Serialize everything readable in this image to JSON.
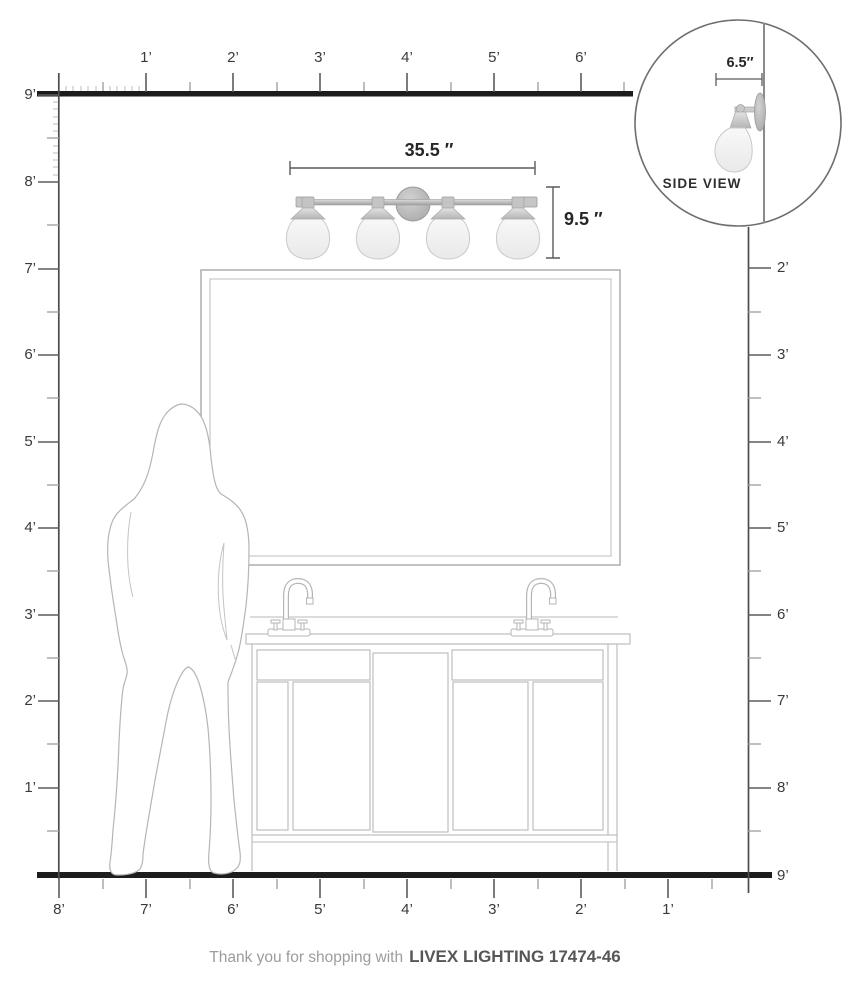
{
  "title": "Livex Lighting 17474-46 scale diagram",
  "rulers": {
    "top": {
      "labels": [
        "1’",
        "2’",
        "3’",
        "4’",
        "5’",
        "6’"
      ]
    },
    "left": {
      "labels": [
        "9’",
        "8’",
        "7’",
        "6’",
        "5’",
        "4’",
        "3’",
        "2’",
        "1’"
      ]
    },
    "right": {
      "labels": [
        "2’",
        "3’",
        "4’",
        "5’",
        "6’",
        "7’",
        "8’"
      ],
      "floor_label": "9’"
    },
    "bottom": {
      "labels": [
        "8’",
        "7’",
        "6’",
        "5’",
        "4’",
        "3’",
        "2’",
        "1’"
      ]
    }
  },
  "dimensions": {
    "fixture_width": "35.5 ″",
    "fixture_height": "9.5 ″",
    "fixture_depth": "6.5″"
  },
  "side_view": {
    "label": "SIDE VIEW"
  },
  "fixture": {
    "light_count": 4,
    "metal_color": "#b8b8b8",
    "glass_color": "#f4f4f4"
  },
  "footer": {
    "prefix": "Thank you for shopping with",
    "product": "LIVEX LIGHTING 17474-46"
  }
}
